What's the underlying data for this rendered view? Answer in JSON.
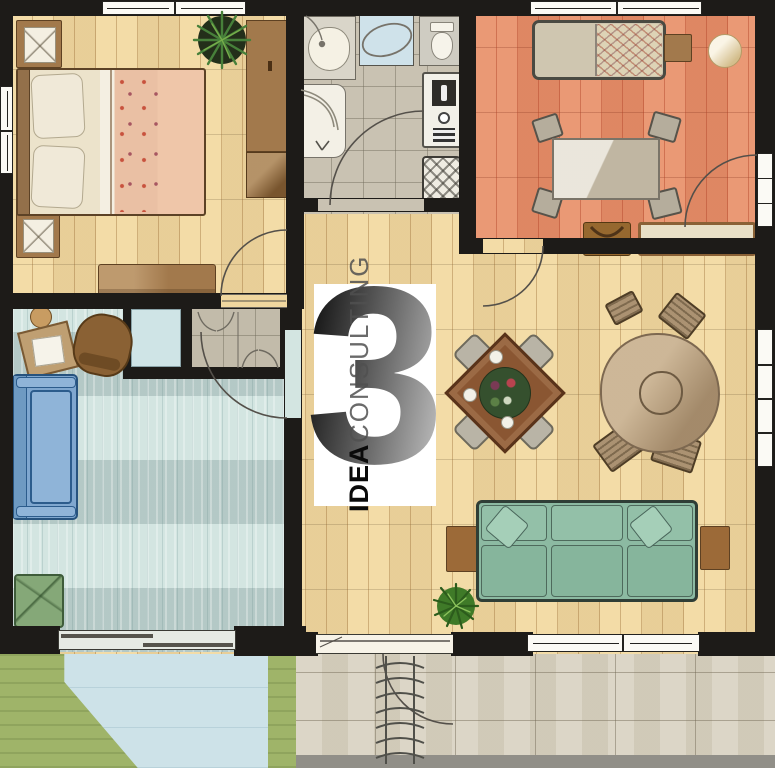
{
  "watermark": {
    "numeral": "3",
    "brand": "IDEA",
    "brand_secondary": "CONSULTING"
  },
  "palette": {
    "wall": "#1d1b18",
    "wood_floor": "#f0d79f",
    "terracotta_floor": "#e58d68",
    "bath_floor": "#c9c2b2",
    "blue_floor": "#d3e5e1",
    "cell_floor": "#c2bbaa",
    "closet_floor": "#cfe4e6",
    "grass": "#9fb469",
    "pool": "#cde2e8",
    "patio": "#d7d0bf",
    "curb": "#918f88",
    "sofa_green": "#8cbaa2",
    "sofa_blue": "#7fa7cf",
    "armchair_green": "#85a878",
    "bed_blanket_salmon": "#ecc3a6",
    "wood_furniture": "#a2794c"
  },
  "rooms": [
    {
      "id": "bedroom",
      "floor": "wood"
    },
    {
      "id": "bathroom",
      "floor": "tile"
    },
    {
      "id": "study-bedroom",
      "floor": "terracotta"
    },
    {
      "id": "living-dining-room",
      "floor": "wood"
    },
    {
      "id": "den-office-room",
      "floor": "blue"
    },
    {
      "id": "storage-cell",
      "floor": "tile"
    },
    {
      "id": "closet-cell",
      "floor": "blue"
    }
  ],
  "outdoor": [
    {
      "id": "garden"
    },
    {
      "id": "pool-terrace"
    },
    {
      "id": "stone-patio"
    }
  ],
  "furniture": [
    "double-bed",
    "pillows",
    "nightstand",
    "nightstand",
    "plant",
    "wardrobe",
    "dresser-bench",
    "vanity-sink",
    "shower-glass",
    "toilet",
    "bathtub",
    "boiler",
    "laundry-basket",
    "single-bed",
    "side-shelf",
    "pouf",
    "study-table",
    "chairs",
    "bench-seat",
    "bag",
    "square-dining-table",
    "centerpiece",
    "plates",
    "round-table",
    "chairs",
    "green-sofa",
    "side-tables",
    "plant",
    "desk",
    "office-chair",
    "stool",
    "blue-sofa",
    "green-armchair",
    "outdoor-stairs"
  ]
}
